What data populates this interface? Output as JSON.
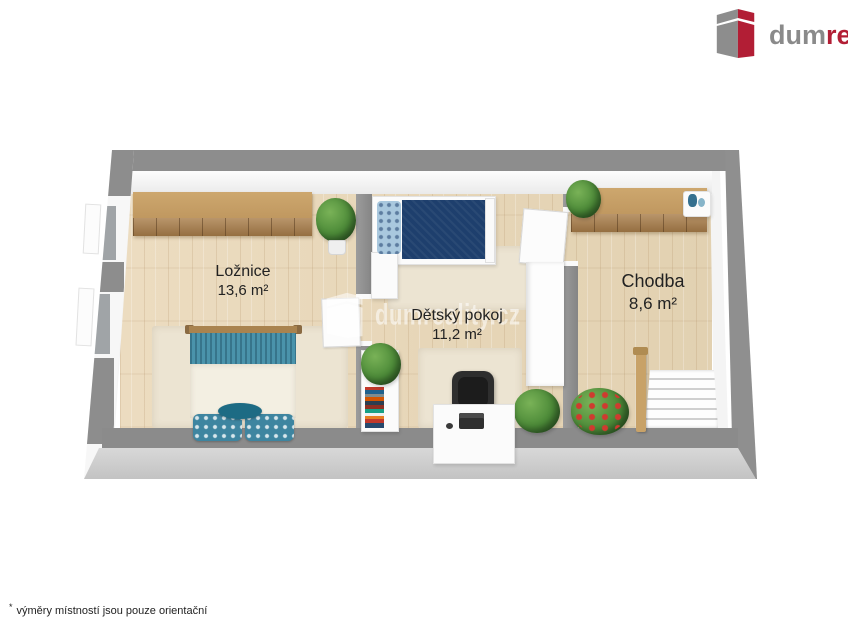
{
  "logo": {
    "icon": "dumreality-cube-icon",
    "text_gray": "dum",
    "text_red": "reality"
  },
  "watermark": {
    "icon": "dumreality-cube-icon",
    "text": "dumreality.cz"
  },
  "rooms": [
    {
      "name": "Ložnice",
      "area": "13,6 m²"
    },
    {
      "name": "Dětský pokoj",
      "area": "11,2 m²"
    },
    {
      "name": "Chodba",
      "area": "8,6 m²"
    }
  ],
  "footnote": {
    "mark": "*",
    "text": "výměry místností jsou pouze orientační"
  },
  "colors": {
    "brand_red": "#b21e35",
    "brand_gray": "#8a8a8a",
    "wall_gray": "#8d8d8d",
    "wall_face_light": "#c9c9c9",
    "floor_wood": "#e8d8bb",
    "furniture_wood": "#c09860",
    "rug": "#ece4d2",
    "bed_teal": "#4a93ab",
    "bed_navy": "#1e3f6d",
    "plant_green": "#4c8a38",
    "label_text": "#222222",
    "background": "#ffffff"
  }
}
